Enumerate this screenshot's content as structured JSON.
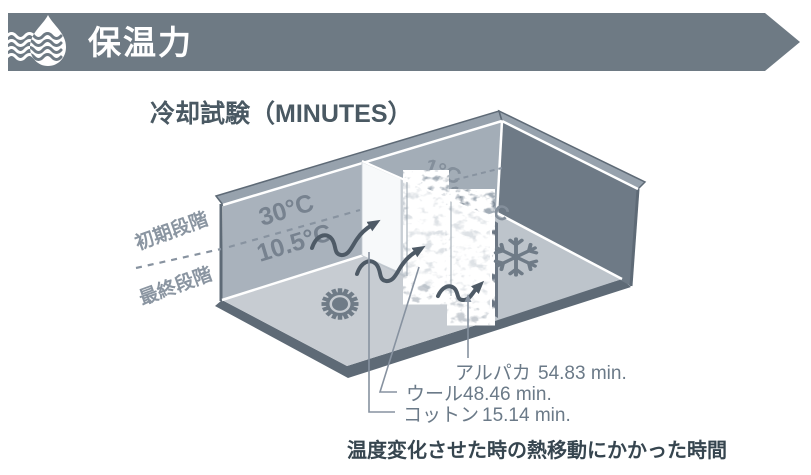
{
  "header": {
    "title": "保温力",
    "icon": "water-drop-icon"
  },
  "figure": {
    "title": "冷却試験（MINUTES）",
    "stages": {
      "initial": "初期段階",
      "final": "最終段階"
    },
    "warm_room": {
      "initial_temp": "30°C",
      "final_temp": "10.5°C",
      "icon": "sun-icon"
    },
    "cold_room": {
      "initial_temp": "1°C",
      "final_temp": "10.5°C",
      "icon": "snowflake-icon"
    },
    "materials": [
      {
        "name": "アルパカ",
        "time": "54.83 min."
      },
      {
        "name": "ウール",
        "time": "48.46 min."
      },
      {
        "name": "コットン",
        "time": "15.14 min."
      }
    ],
    "caption": "温度変化させた時の熱移動にかかった時間"
  },
  "colors": {
    "banner": "#6E7A84",
    "banner_text": "#FFFFFF",
    "title_text": "#4A5963",
    "wall_warm": "#A9B2BC",
    "wall_cold": "#A3ADB7",
    "wall_right_dark": "#6E7A86",
    "floor_warm": "#C7CCD2",
    "floor_cold": "#BDC4CB",
    "rim_dark": "#5E6A76",
    "arrow": "#4E5A66",
    "label_text": "#6B7A88",
    "caption_text": "#36454F"
  }
}
